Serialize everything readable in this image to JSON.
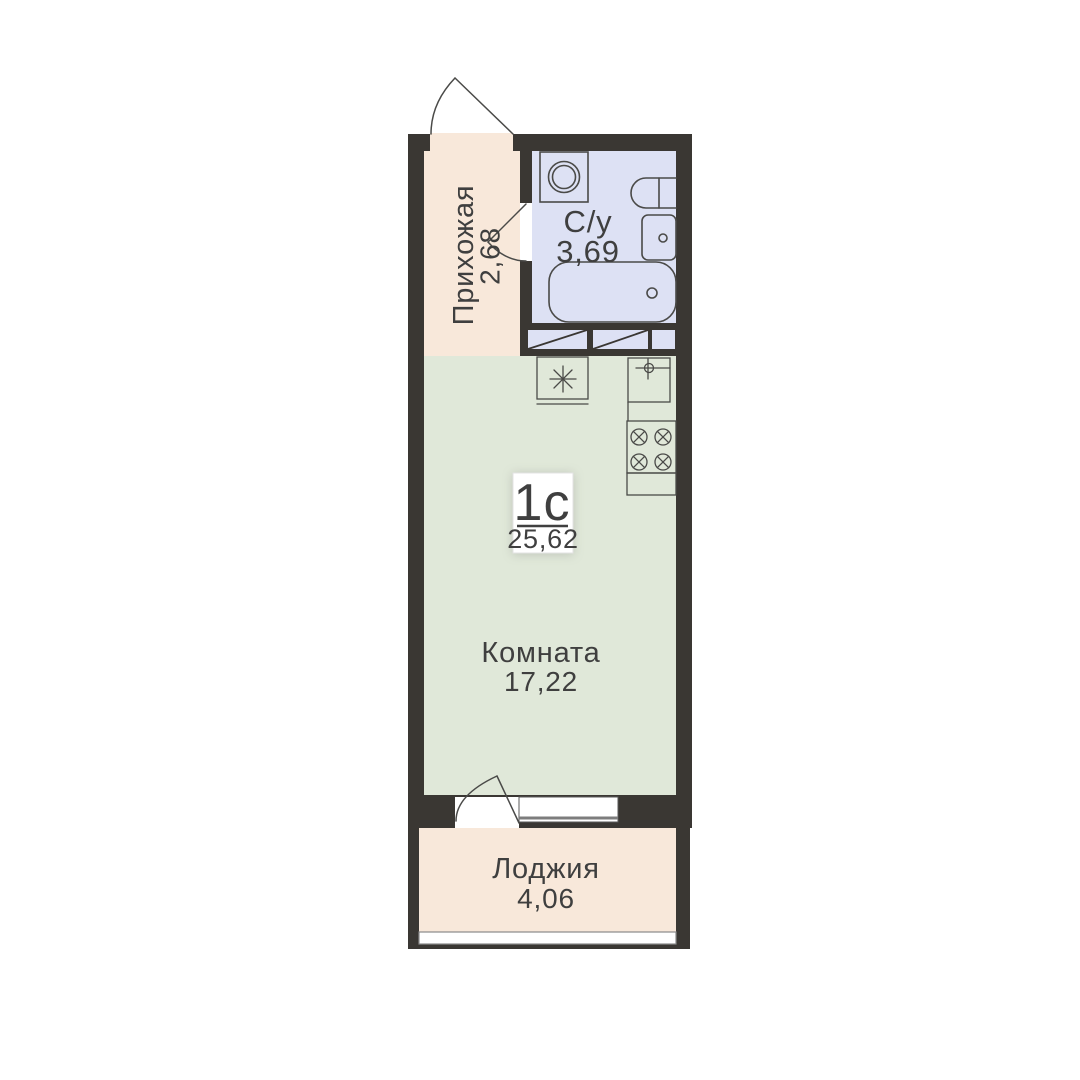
{
  "plan": {
    "type_label": "1с",
    "total_area": "25,62",
    "hallway": {
      "name": "Прихожая",
      "area": "2,68"
    },
    "bathroom": {
      "name": "С/у",
      "area": "3,69"
    },
    "room": {
      "name": "Комната",
      "area": "17,22"
    },
    "loggia": {
      "name": "Лоджия",
      "area": "4,06"
    }
  },
  "colors": {
    "wall": "#3a3733",
    "hallway_floor": "#f8e8da",
    "bathroom_floor": "#dde1f4",
    "room_floor": "#e0e8d9",
    "loggia_floor": "#f8e8da",
    "fixture_outline": "#4a4a48",
    "window_line": "#7d7d7d",
    "text": "#3f3f3f",
    "label_box": "#ffffff"
  }
}
